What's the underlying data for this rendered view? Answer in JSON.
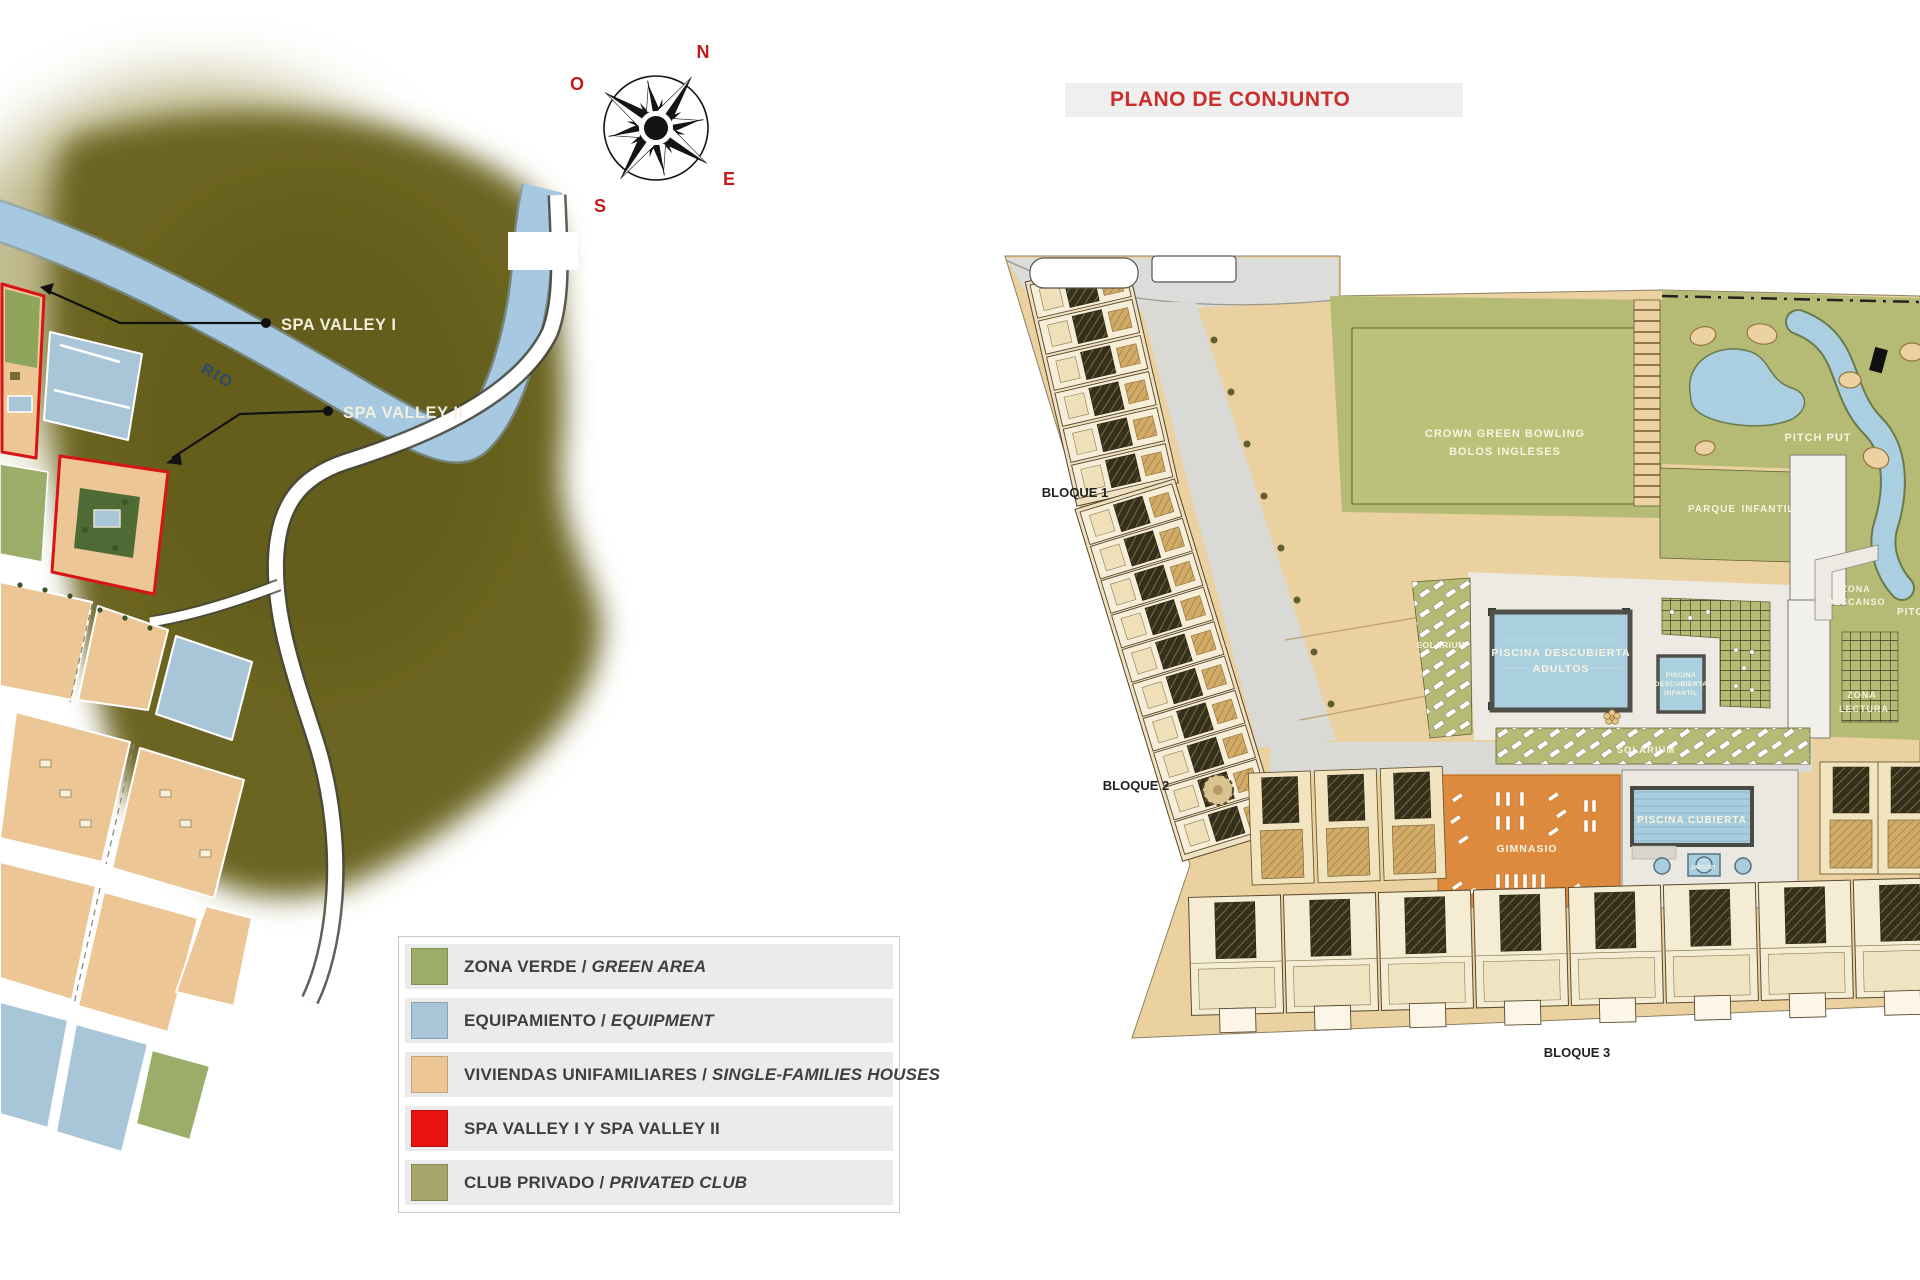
{
  "title_bar": {
    "label": "PLANO DE CONJUNTO",
    "text_color": "#c9302a"
  },
  "location_map": {
    "river_label": "RIO",
    "spa_outline_color": "#d81414",
    "compass": {
      "north": "N",
      "west": "O",
      "east": "E",
      "south": "S",
      "letter_color": "#c11b1b"
    },
    "callouts": {
      "spa_valley_1": "SPA VALLEY I",
      "spa_valley_2": "SPA VALLEY II"
    },
    "legend": {
      "items": [
        {
          "label_es": "ZONA VERDE",
          "separator": " / ",
          "label_en": "GREEN AREA",
          "color": "#9cad6a"
        },
        {
          "label_es": "EQUIPAMIENTO",
          "separator": " / ",
          "label_en": "EQUIPMENT",
          "color": "#a9c6d8"
        },
        {
          "label_es": "VIVIENDAS UNIFAMILIARES",
          "separator": " / ",
          "label_en": "SINGLE-FAMILIES HOUSES",
          "color": "#ecc795"
        },
        {
          "label_es": "SPA VALLEY I Y SPA VALLEY II",
          "separator": "",
          "label_en": "",
          "color": "#e81212"
        },
        {
          "label_es": "CLUB PRIVADO",
          "separator": " / ",
          "label_en": "PRIVATED CLUB",
          "color": "#a6a66b"
        }
      ]
    }
  },
  "site_plan": {
    "blocks": {
      "bloque_1": "BLOQUE 1",
      "bloque_2": "BLOQUE 2",
      "bloque_3": "BLOQUE 3"
    },
    "areas": {
      "crown_green_bowling_line1": "CROWN GREEN BOWLING",
      "crown_green_bowling_line2": "BOLOS INGLESES",
      "pitch_put": "PITCH PUT",
      "pitch_put_east": "PITCH PUT",
      "parque_infantil_word1": "PARQUE",
      "parque_infantil_word2": "INFANTIL",
      "zona_descanso_line1": "ZONA",
      "zona_descanso_line2": "DESCANSO",
      "zona_lectura_line1": "ZONA",
      "zona_lectura_line2": "LECTURA",
      "solarium_west": "SOLARIUM",
      "solarium_south": "SOLARIUM",
      "piscina_adultos_line1": "PISCINA DESCUBIERTA",
      "piscina_adultos_line2": "ADULTOS",
      "piscina_infantil_line1": "PISCINA",
      "piscina_infantil_line2": "DESCUBIERTA",
      "piscina_infantil_line3": "INFANTIL",
      "gimnasio": "GIMNASIO",
      "piscina_cubierta": "PISCINA CUBIERTA",
      "jacuzzi": "JACUZZI"
    }
  }
}
